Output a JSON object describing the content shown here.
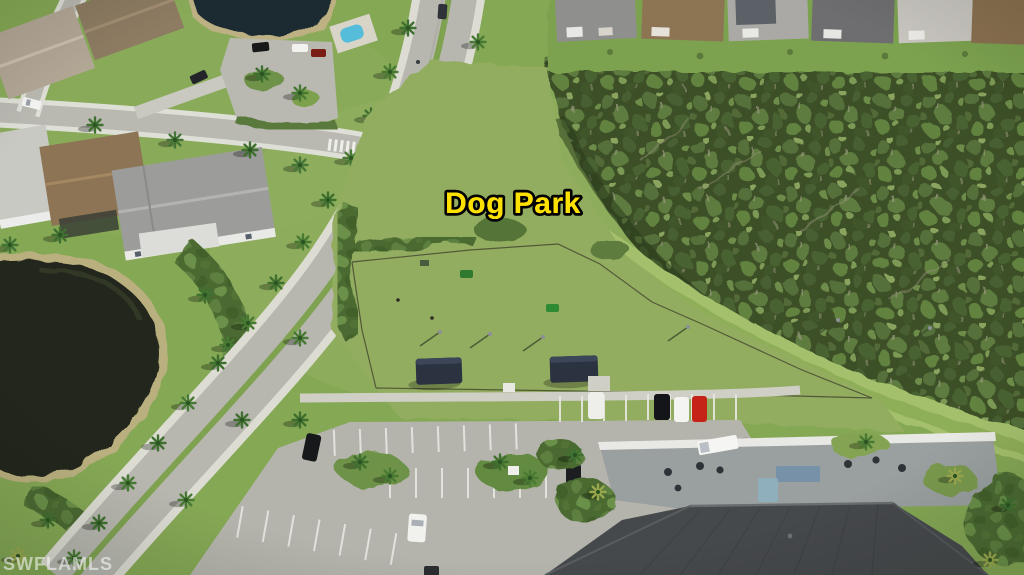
{
  "overlay": {
    "park_label": "Dog Park",
    "watermark": "SWFLAMLS"
  },
  "palette": {
    "label_yellow": "#FFE100",
    "label_outline": "#000000",
    "watermark_white": "#FFFFFF",
    "lawn_green": "#85a855",
    "dogpark_green": "#93ad60",
    "forest_green": "#3d4f28",
    "berm_light_green": "#a4c06c",
    "road_gray": "#b7b7af",
    "sidewalk_gray": "#dcdcd3",
    "parking_gray": "#b4b4ac",
    "pond_dark": "#20251a",
    "lake_top_dark": "#1e2a33",
    "pool_blue": "#55bcd9",
    "roof_brown": "#8d7454",
    "roof_gray": "#9c9c9a",
    "clubhouse_roof": "#46494c",
    "shelter_navy": "#2b3240",
    "car_red": "#c52318",
    "car_white": "#f4f4f2",
    "car_black": "#17181a"
  }
}
